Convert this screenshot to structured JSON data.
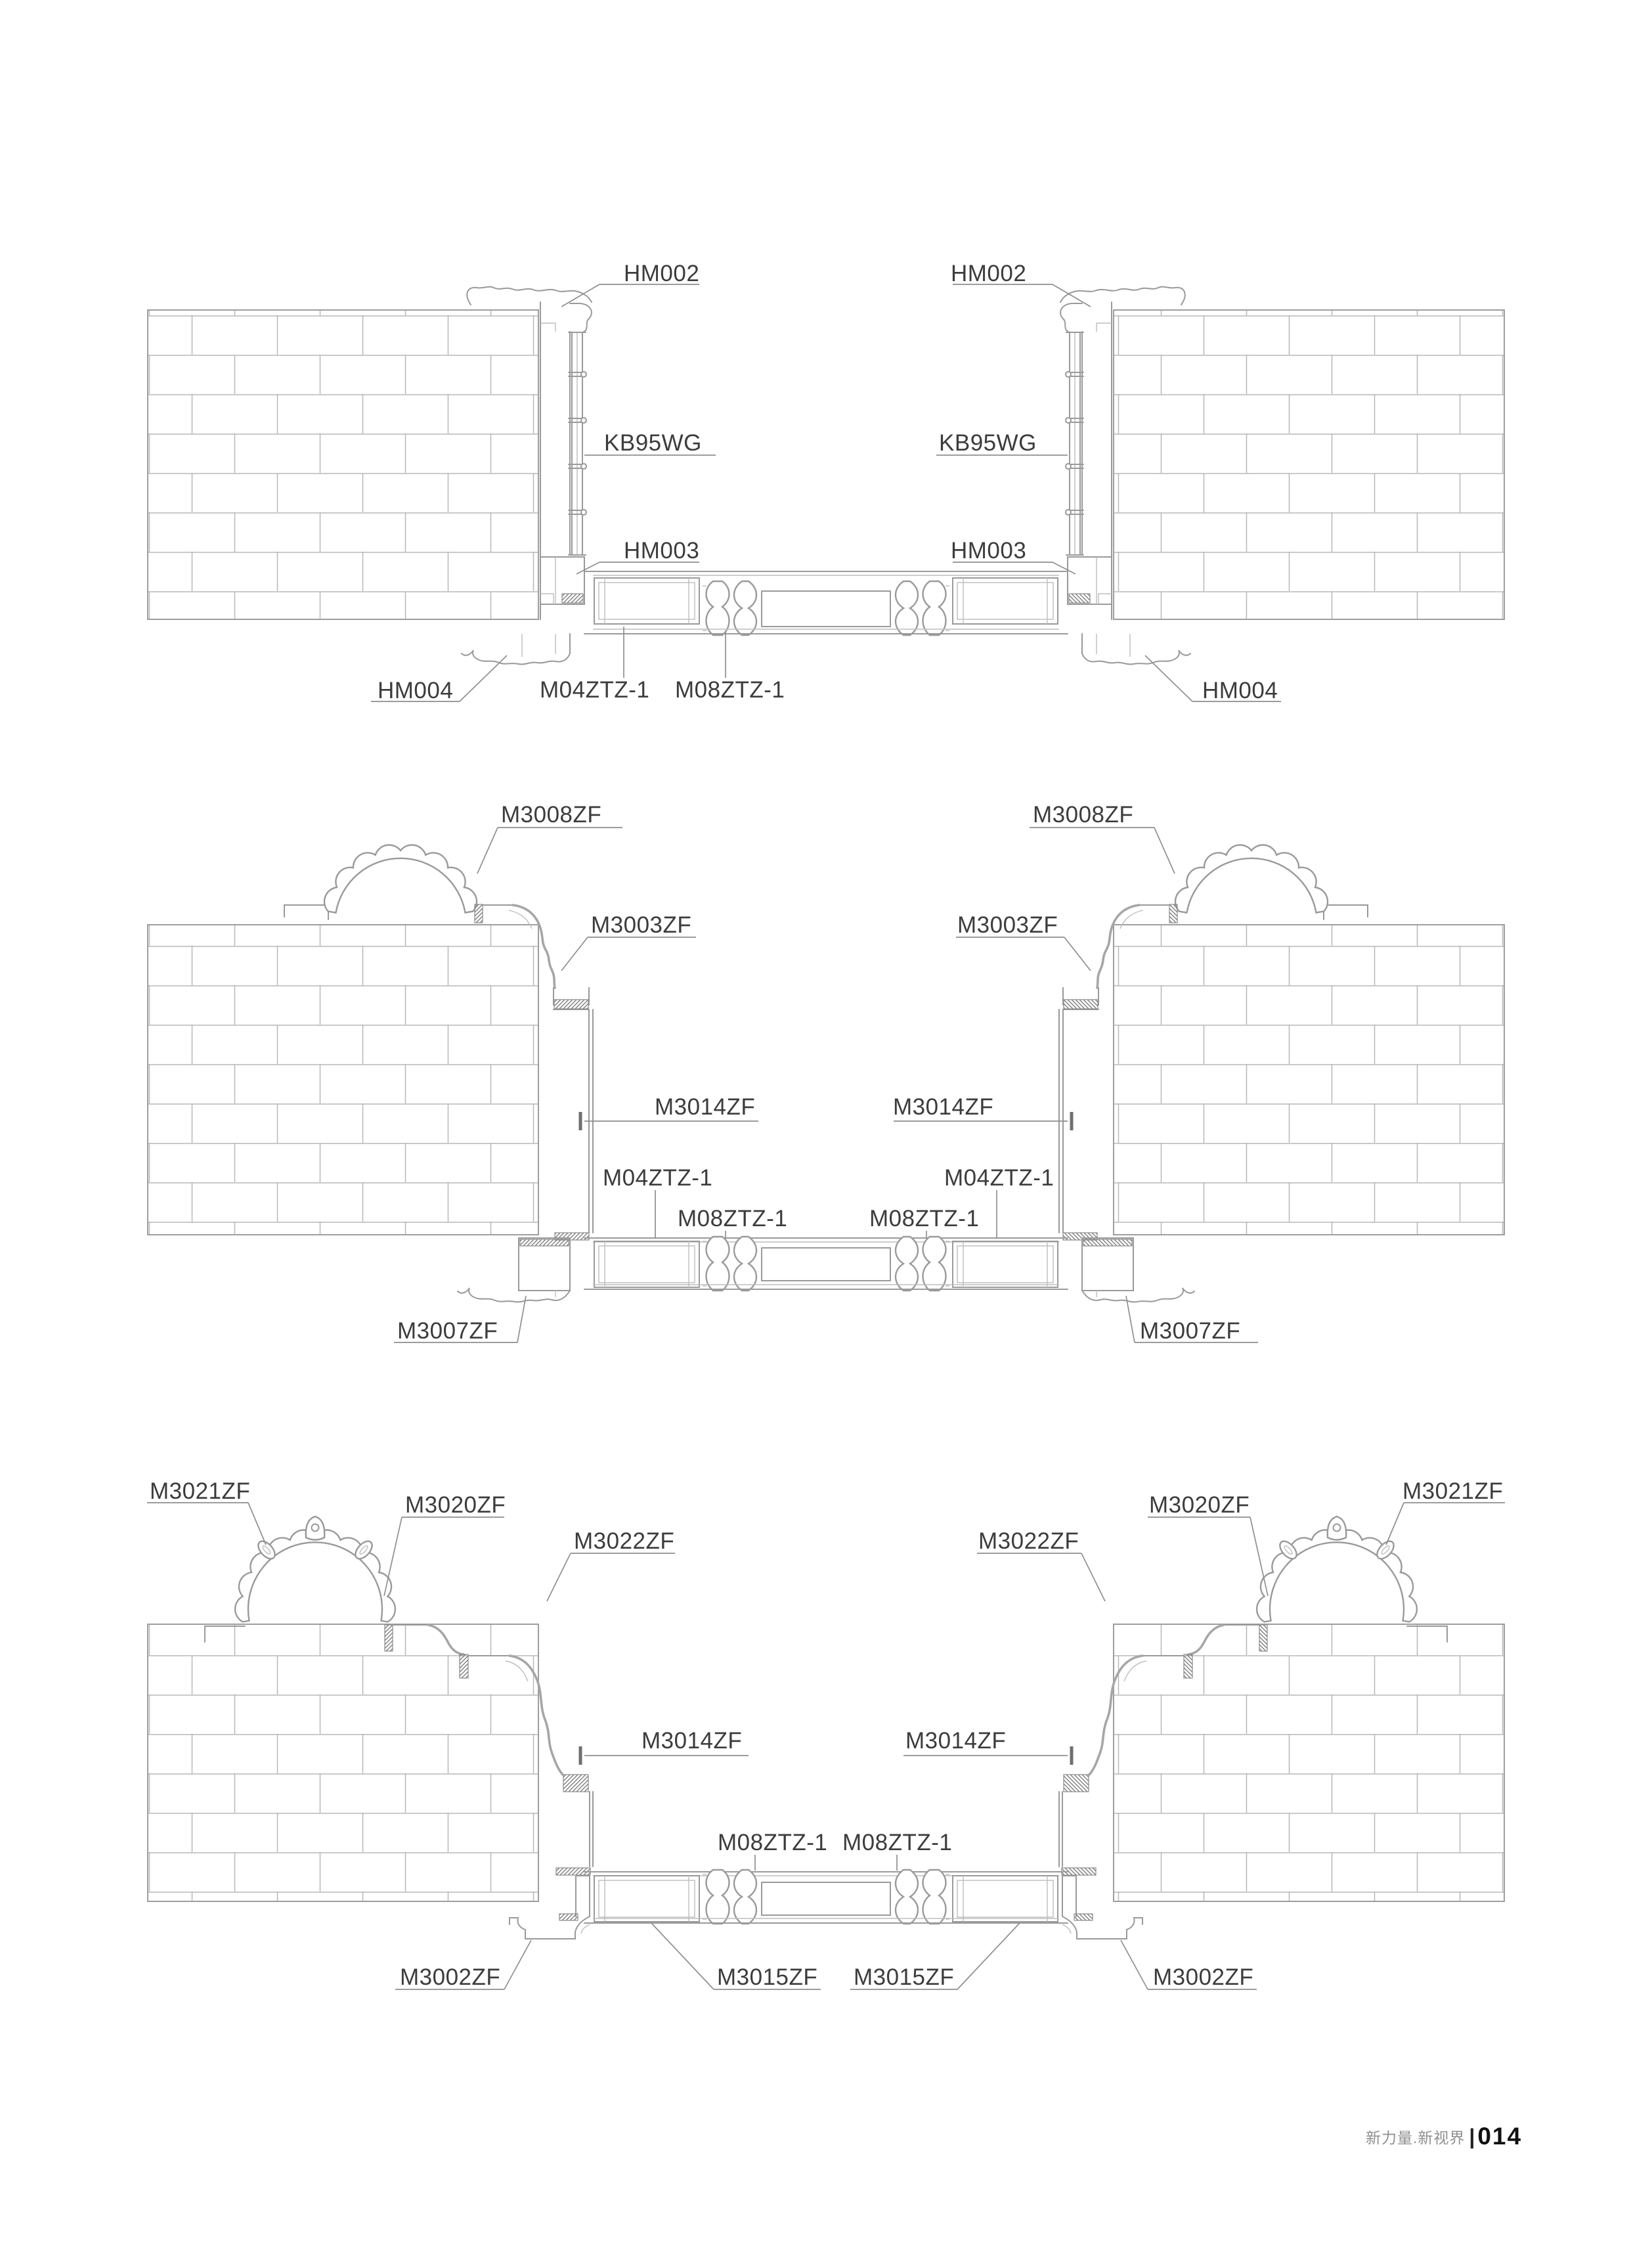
{
  "footer": {
    "slogan": "新力量.新视界",
    "divider": "|",
    "page_number": "014"
  },
  "colors": {
    "line": "#9a9a9a",
    "label_text": "#3c3c3c",
    "page_number": "#111111"
  },
  "diagrams": {
    "top": {
      "title": "door head / jamb / sill section detail 1",
      "labels": {
        "hm002": "HM002",
        "kb95wg": "KB95WG",
        "hm003": "HM003",
        "hm004": "HM004",
        "m04ztz": "M04ZTZ-1",
        "m08ztz": "M08ZTZ-1"
      }
    },
    "middle": {
      "title": "door section detail 2 with scalloped arch pediment",
      "labels": {
        "m3008zf": "M3008ZF",
        "m3003zf": "M3003ZF",
        "m3014zf": "M3014ZF",
        "m04ztz": "M04ZTZ-1",
        "m08ztz": "M08ZTZ-1",
        "m3007zf": "M3007ZF"
      }
    },
    "bottom": {
      "title": "door section detail 3 with ornamented arch pediment",
      "labels": {
        "m3021zf": "M3021ZF",
        "m3020zf": "M3020ZF",
        "m3022zf": "M3022ZF",
        "m3014zf": "M3014ZF",
        "m08ztz": "M08ZTZ-1",
        "m3015zf": "M3015ZF",
        "m3002zf": "M3002ZF"
      }
    }
  }
}
